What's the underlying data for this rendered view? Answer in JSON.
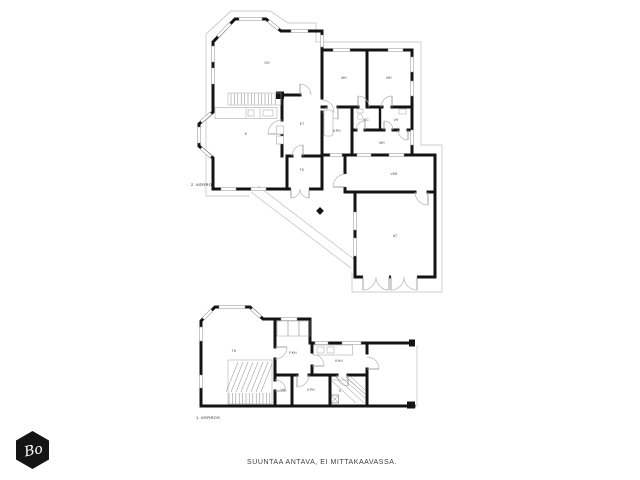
{
  "caption": "SUUNTAA ANTAVA, EI MITTAKAAVASSA.",
  "logo": {
    "text": "Bo"
  },
  "colors": {
    "wall": "#141414",
    "window_line": "#909090",
    "door_arc": "#b5b5b5",
    "eaves": "#cccccc",
    "label": "#444444",
    "logo_bg": "#141414",
    "logo_fg": "#ffffff"
  },
  "floors": [
    {
      "label": "2. KERROS",
      "rooms": [
        {
          "name": "living-room",
          "label": "OH"
        },
        {
          "name": "kitchen",
          "label": "K"
        },
        {
          "name": "entry-hall",
          "label": "ET"
        },
        {
          "name": "vestibule",
          "label": "TK"
        },
        {
          "name": "bedroom-1",
          "label": "MH"
        },
        {
          "name": "bedroom-2",
          "label": "MH"
        },
        {
          "name": "bathroom",
          "label": "KPH"
        },
        {
          "name": "wc",
          "label": "WC"
        },
        {
          "name": "closet",
          "label": "VH"
        },
        {
          "name": "bedroom-3",
          "label": "MH"
        },
        {
          "name": "storage",
          "label": "VAR"
        },
        {
          "name": "garage",
          "label": "AT"
        }
      ]
    },
    {
      "label": "1. KERROS",
      "rooms": [
        {
          "name": "fireplace-room",
          "label": "TH"
        },
        {
          "name": "dressing-room",
          "label": "PKH"
        },
        {
          "name": "utility-room",
          "label": "KHH"
        },
        {
          "name": "closet",
          "label": "VH"
        },
        {
          "name": "bathroom",
          "label": "KPH"
        },
        {
          "name": "sauna",
          "label": "S"
        }
      ]
    }
  ]
}
